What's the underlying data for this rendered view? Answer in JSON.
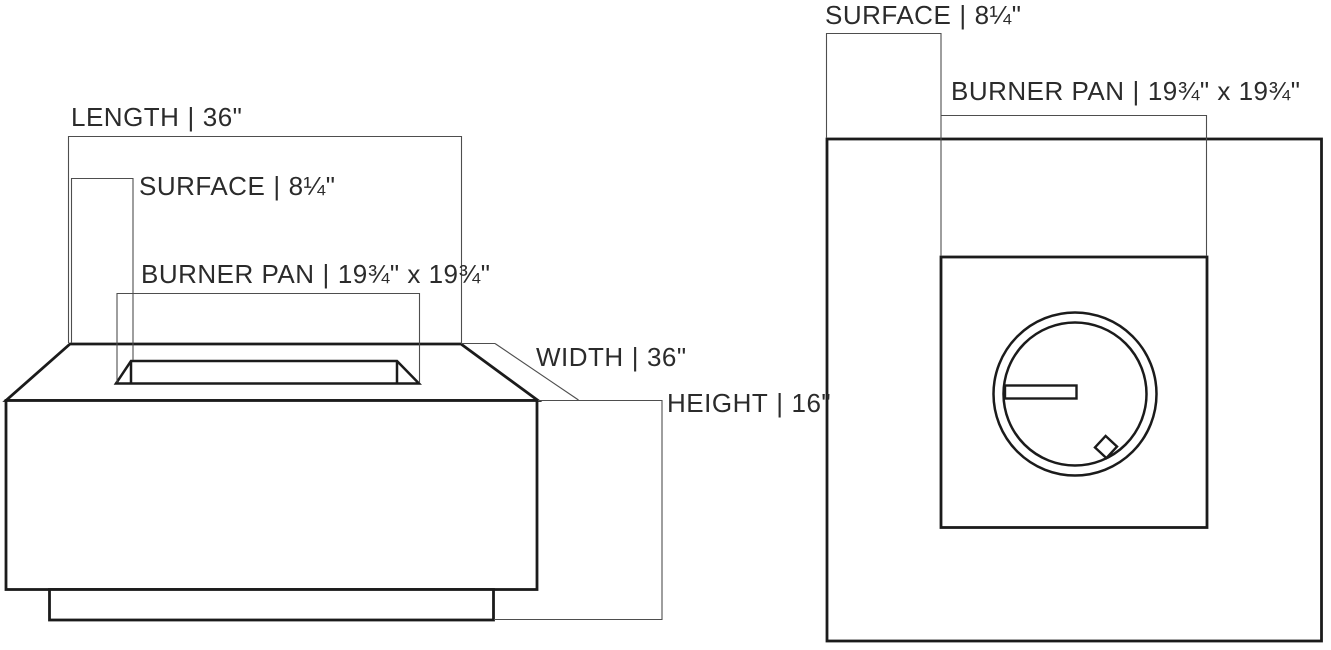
{
  "page": {
    "background": "#ffffff",
    "line_color": "#1b1b1b",
    "dim_line_color": "#4e4e4e",
    "text_color": "#2b2b2b",
    "separator": "|"
  },
  "front_view": {
    "length": {
      "label": "LENGTH",
      "value": "36\""
    },
    "surface": {
      "label": "SURFACE",
      "value": "8¼\""
    },
    "burner_pan": {
      "label": "BURNER PAN",
      "value": "19¾\" x 19¾\""
    },
    "width": {
      "label": "WIDTH",
      "value": "36\""
    },
    "height": {
      "label": "HEIGHT",
      "value": "16\""
    }
  },
  "top_view": {
    "surface": {
      "label": "SURFACE",
      "value": "8¼\""
    },
    "burner_pan": {
      "label": "BURNER PAN",
      "value": "19¾\" x 19¾\""
    }
  }
}
